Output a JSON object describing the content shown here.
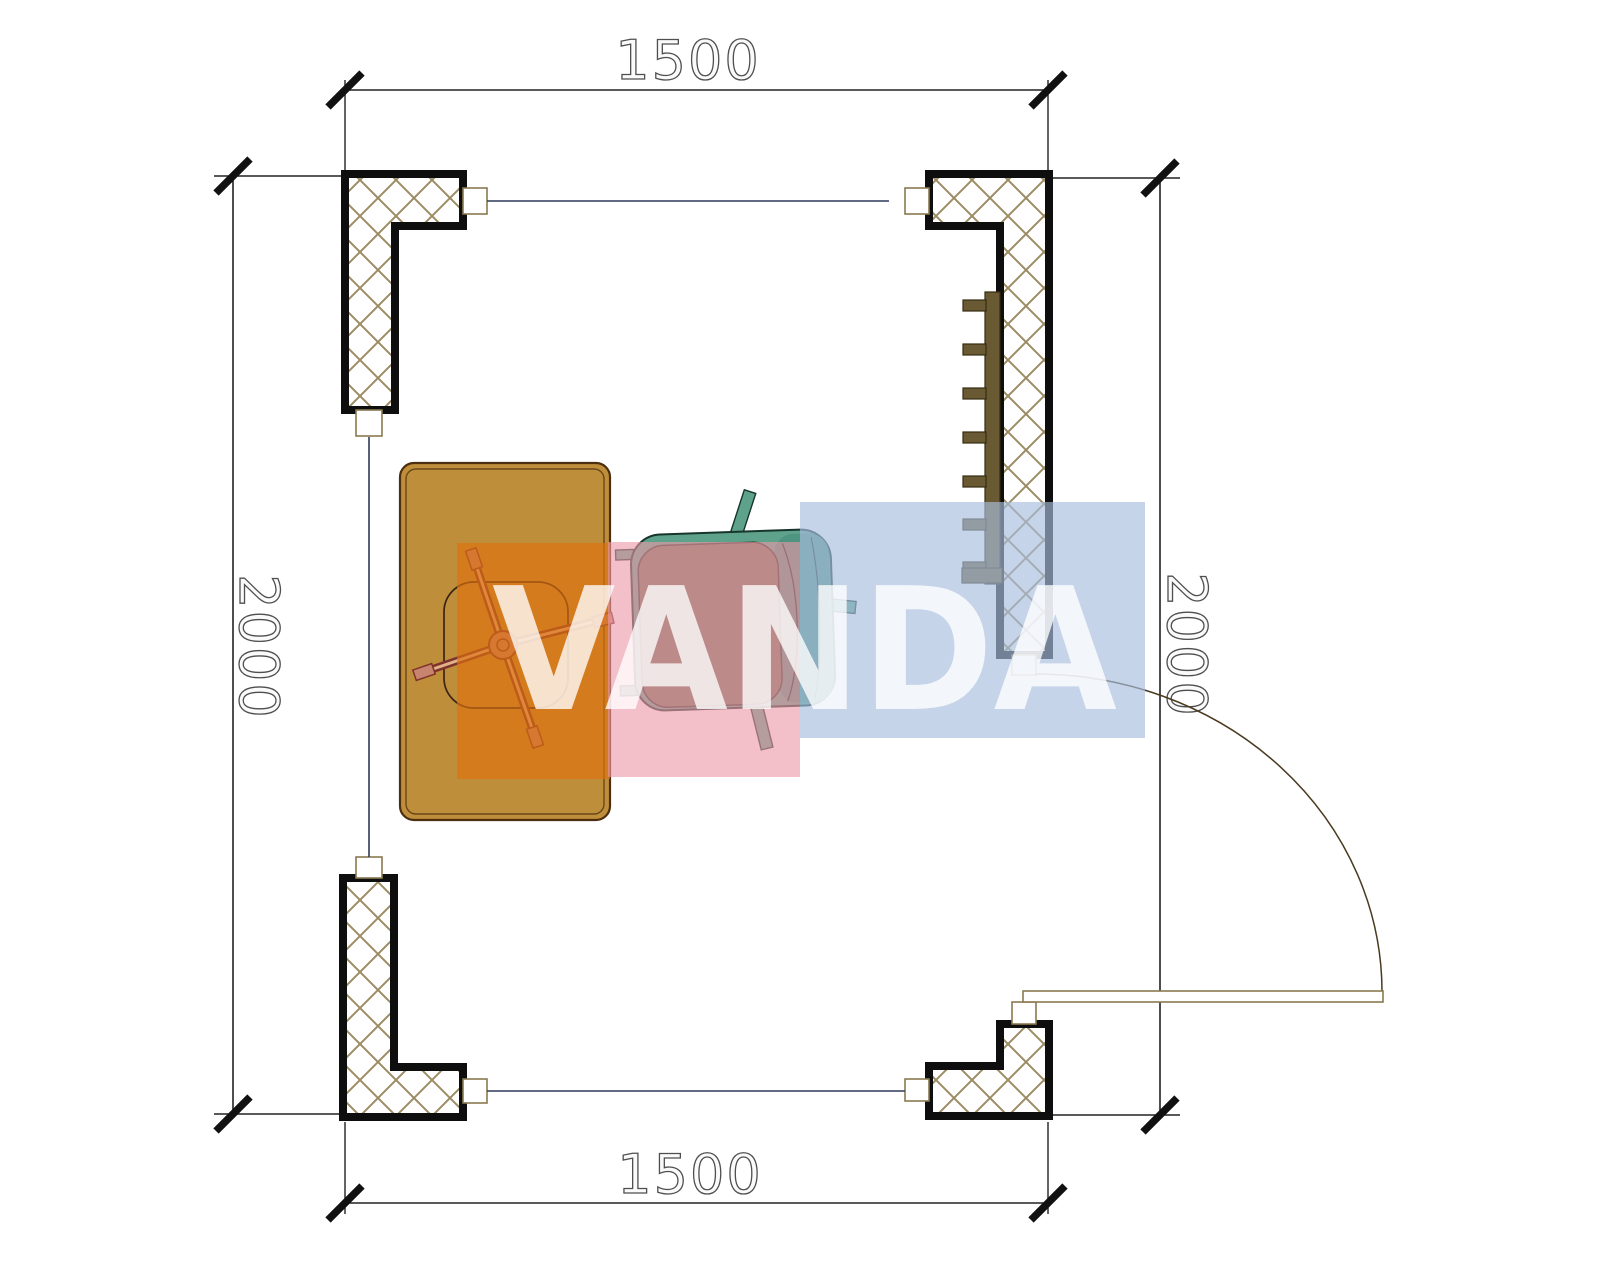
{
  "page": {
    "title": "Floor plan 1500 x 2000 with desk, office chair, armchair, radiator and door"
  },
  "dimensions": {
    "top": "1500",
    "bottom": "1500",
    "left": "2000",
    "right": "2000"
  },
  "watermark": {
    "text": "VANDA"
  },
  "colors": {
    "wall-outline": "#0e0e0e",
    "hatch-line": "#9b8c64",
    "window-line": "#2e3a5c",
    "dim-line": "#222222",
    "desk-fill": "#bf8e3b",
    "desk-outline": "#4d2f10",
    "radiator-fill": "#6a5a33",
    "radiator-outline": "#352b12",
    "chair-leg": "#7e322b",
    "chair-leg-inner": "#e0b28a",
    "caster-fill": "#c8846e",
    "armchair-shell": "#5ea28c",
    "armchair-band": "#4f9480",
    "armchair-cushion": "#6f7758",
    "armchair-outline": "#16352c",
    "door-line": "#8a7a50",
    "wm-orange": "rgba(222,113,16,0.65)",
    "wm-pink": "rgba(236,152,168,0.62)",
    "wm-blue": "rgba(168,190,222,0.66)",
    "wm-text": "rgba(255,255,255,0.78)"
  }
}
